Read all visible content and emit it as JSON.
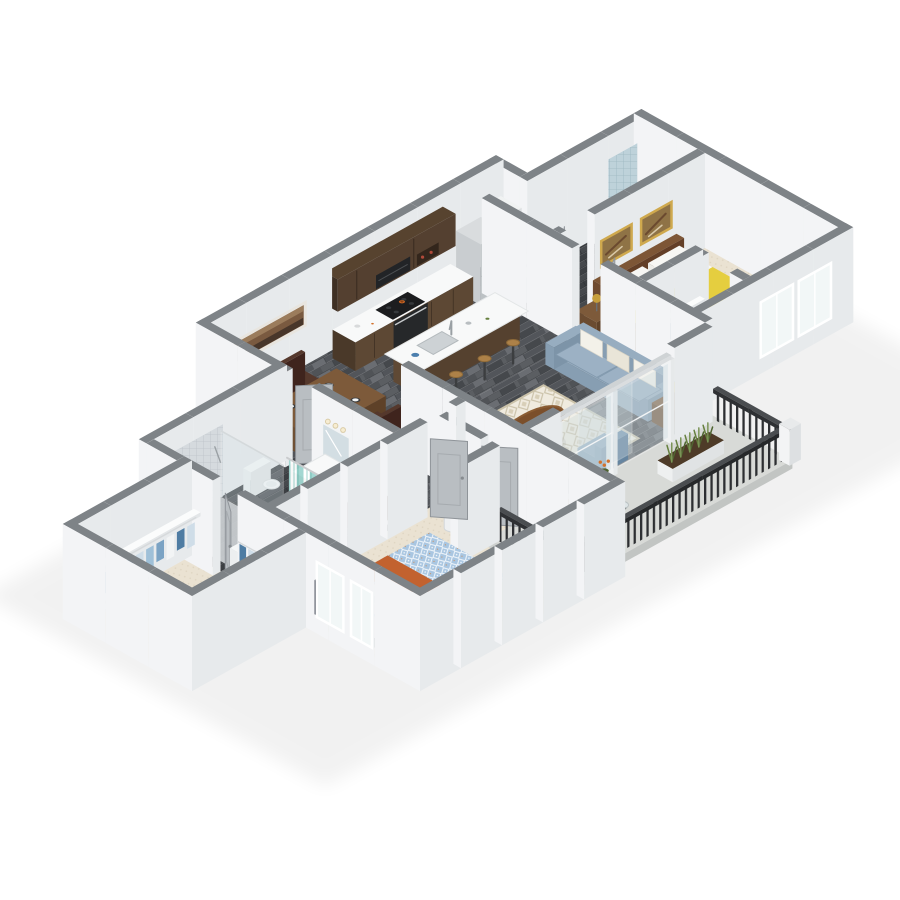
{
  "scene": {
    "type": "3d-isometric-floor-plan",
    "description": "3D rendered isometric floor plan of a two-bedroom, two-bathroom apartment with open kitchen, dining area, living room, private balcony and walk-in closet",
    "rooms": [
      {
        "name": "kitchen",
        "objects": [
          "upper-cabinets",
          "lower-cabinets-with-range",
          "cooktop-with-pan",
          "refrigerator",
          "pantry-cabinet",
          "island-with-sink",
          "bar-stools"
        ]
      },
      {
        "name": "dining-area",
        "objects": [
          "dining-table",
          "four-wood-chairs",
          "panoramic-wall-art",
          "place-settings"
        ]
      },
      {
        "name": "living-room",
        "objects": [
          "blue-sofa",
          "throw-pillows",
          "oval-coffee-table",
          "diamond-pattern-rug",
          "blue-accent-chair",
          "side-table-with-yellow-lamp",
          "sliding-glass-doors"
        ]
      },
      {
        "name": "hallway-entry",
        "objects": [
          "entry-door",
          "water-heater-closet",
          "interior-doors"
        ]
      },
      {
        "name": "primary-bedroom",
        "objects": [
          "bed-with-blue-patterned-quilt",
          "orange-throw-blanket",
          "dark-headboard",
          "pillows",
          "windows",
          "yellow-bedside-lamp"
        ]
      },
      {
        "name": "primary-bathroom",
        "objects": [
          "tiled-walk-in-shower",
          "soaking-tub",
          "striped-shower-curtain",
          "toilet",
          "dark-wood-vanity",
          "mirror-with-lights"
        ]
      },
      {
        "name": "walk-in-closet",
        "objects": [
          "wire-shelving",
          "hanging-clothes",
          "shoe-racks"
        ]
      },
      {
        "name": "bedroom-2",
        "objects": [
          "bed-with-yellow-blanket",
          "brown-headboard",
          "two-framed-artworks",
          "nightstand-with-gold-lamp",
          "dresser-with-flowers",
          "wire-shelf-closet",
          "windows"
        ]
      },
      {
        "name": "bathroom-2",
        "objects": [
          "tub-with-teal-water",
          "striped-shower-curtain",
          "blue-tile-surround",
          "toilet",
          "white-vanity"
        ]
      },
      {
        "name": "balcony",
        "objects": [
          "dark-metal-picket-railing",
          "white-corner-posts",
          "two-wicker-chairs",
          "glass-side-table",
          "planter-box",
          "potted-orange-flowers",
          "concrete-floor"
        ]
      }
    ]
  },
  "colors": {
    "background": "#ffffff",
    "wall_top": "#7e8387",
    "wall_light": "#f3f4f6",
    "wall_shade": "#e7eaec",
    "wood_a": "#5b5e62",
    "wood_b": "#52555a",
    "wood_c": "#45484c",
    "wood_d": "#6a6d72",
    "wood_seam": "#3e4145",
    "bath_a": "#46494d",
    "bath_b": "#3c3f43",
    "carpet": "#eae2d2",
    "carpet_dot": "#ddd3c0",
    "concrete": "#d8dad7",
    "concrete_front": "#c2c5c3",
    "concrete_side": "#ced1cf",
    "rug_base": "#f0ebdf",
    "rug_line": "#cbc2a9",
    "rug_diamond": "#d8cfb8",
    "counter": "#f8f9f9",
    "cab_side": "#4a3929",
    "cab_front": "#5d4834",
    "upper_top": "#57432f",
    "upper_side": "#3f3024",
    "upper_front": "#544030",
    "island_side": "#5f4935",
    "island_front": "#55412f",
    "appliance": "#26282a",
    "cooktop": "#1c1d1f",
    "burner": "#36393c",
    "pan": "#d06a26",
    "fridge_top": "#d9dcde",
    "fridge_side": "#c9cdd0",
    "fridge_front": "#bcc1c4",
    "handle": "#8e9498",
    "pantry_top": "#f0f2f2",
    "pantry_side": "#e6e9ea",
    "pantry_front": "#dcdfe1",
    "table_top": "#7d5a3a",
    "table_side": "#6f5034",
    "table_front": "#5e4128",
    "chair_top": "#55382c",
    "chair_side": "#4a2f26",
    "chair_front": "#3f241d",
    "stool": "#ad8148",
    "stool_edge": "#8e6a39",
    "metal": "#9aa0a4",
    "sofa_top": "#97adc0",
    "sofa_side": "#879eb2",
    "sofa_front": "#7d94a8",
    "cushion": "#9cb1c4",
    "cushion_seam": "#8299ad",
    "pillow": "#f3f1e9",
    "pillow_warm": "#e9e5d8",
    "coffee": "#7b4f2b",
    "coffee_rim": "#8a5c33",
    "coffee_leg": "#4e2f17",
    "accent_top": "#7e9cb5",
    "accent_side": "#7292ad",
    "accent_front": "#6685a0",
    "quilt": "#a9c6e1",
    "quilt_line": "#ffffff",
    "quilt_dot": "#d08a4f",
    "throw": "#c2622f",
    "throw_side": "#b2582a",
    "head_top": "#454c59",
    "head_side": "#39404c",
    "head_front": "#323945",
    "sheet": "#f7f7f4",
    "mattress_side": "#ebebe7",
    "mattress_front": "#dededa",
    "bed2_top": "#7d5636",
    "bed2_side": "#6f4b30",
    "bed2_front": "#633f27",
    "blanket": "#e5ce3f",
    "blanket_side": "#d8c238",
    "blanket_fold": "#efdb62",
    "night_top": "#7d5a3a",
    "night_side": "#6b4c31",
    "night_front": "#5f4229",
    "lamp_yellow": "#e7c53e",
    "lamp_gold": "#c79f3c",
    "lamp_stem": "#6b6e71",
    "tile": "#d5dade",
    "tile_line": "#bcc3c8",
    "tile2": "#bed2da",
    "tile2_line": "#9db7c1",
    "water": "#7cc8d3",
    "white_top": "#f6f8f8",
    "white_side": "#eceff0",
    "white_front": "#e2e5e6",
    "porcelain": "#f7f9f9",
    "porcelain_edge": "#dde1e1",
    "vanity_side": "#503e2f",
    "vanity_front": "#46362a",
    "mirror": "#d3dee3",
    "mirror_frame": "#f2f4f5",
    "light_warm": "#f7edd2",
    "light_edge": "#d9cba6",
    "curtain_a": "#9fd6d0",
    "curtain_b": "#ffffff",
    "curtain_c": "#cfe9e6",
    "curtain_d": "#8ccac3",
    "rod": "#caccce",
    "glass": "#d3e0e5",
    "glass_frame": "#f2f4f5",
    "glass_table": "#dfe7ea",
    "door": "#b9bec2",
    "door_edge": "#8f9499",
    "door_inset": "#a6abaf",
    "knob": "#878c90",
    "rail_slat": "#2d2f32",
    "rail_top": "#4a4d50",
    "rail_side": "#2e3033",
    "rail_front": "#26282a",
    "wicker_top": "#b59465",
    "wicker": "#a8895a",
    "wicker_dark": "#97794c",
    "wicker_edge": "#8d7244",
    "plant": "#66803f",
    "plant_dark": "#4e6330",
    "flower": "#d3722c",
    "planter_side": "#eef0f0",
    "planter_front": "#e0e3e4",
    "soil": "#4e3b28",
    "wire": "#f7f8f9",
    "wire_edge": "#e3e6e8",
    "clothes": [
      "#7ba3c4",
      "#f2f4f5",
      "#4e7ca3",
      "#cfdde8",
      "#9fc0d8"
    ],
    "shoe": "#3a4550",
    "shoe2": "#6b4c31",
    "art_frame": "#e8e5df",
    "art_fill": "#7a5a40",
    "art_band_dark": "#48362a",
    "art_band_light": "#9b7c5c",
    "gold_frame": "#cfa94e",
    "art2_fill": "#8f7346",
    "art2_dark": "#6b4a2f",
    "art2_light": "#d9c9a8",
    "window_glass": "#f2f7f7",
    "window_frame": "#ffffff",
    "wh_body": "#eef0f1",
    "wh_edge": "#d3d7d9",
    "shadow": "#000000"
  }
}
